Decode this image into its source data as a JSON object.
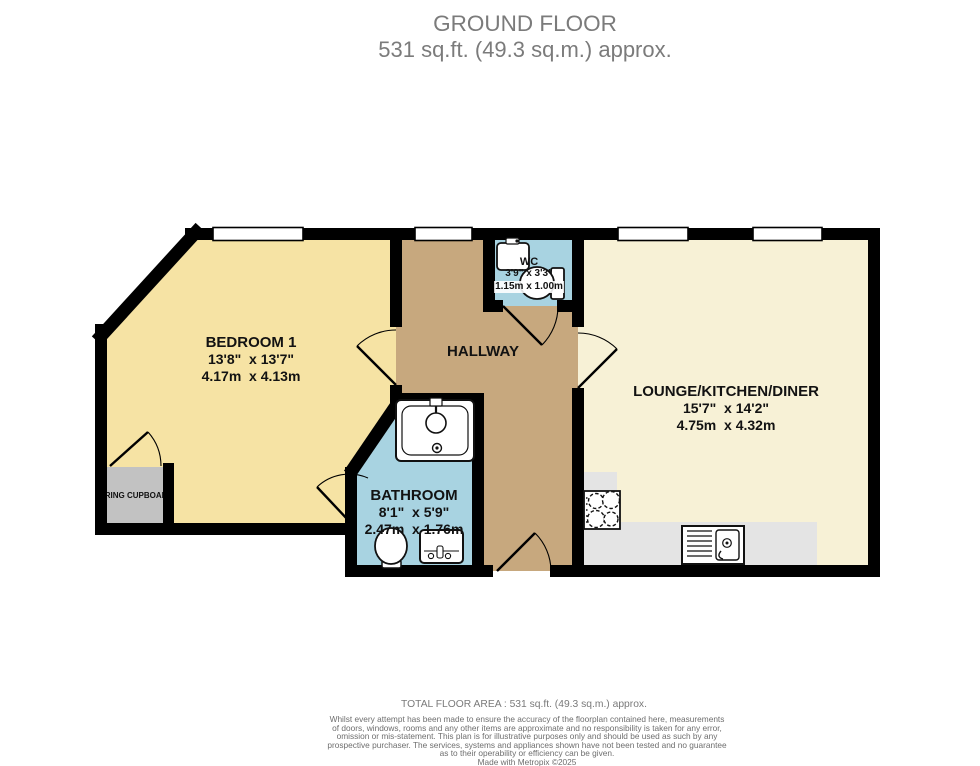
{
  "title": {
    "line1": "GROUND FLOOR",
    "line2": "531 sq.ft. (49.3 sq.m.) approx."
  },
  "rooms": {
    "bedroom": {
      "name": "BEDROOM 1",
      "imperial": "13'8\"  x 13'7\"",
      "metric": "4.17m  x 4.13m"
    },
    "hallway": {
      "name": "HALLWAY"
    },
    "lounge": {
      "name": "LOUNGE/KITCHEN/DINER",
      "imperial": "15'7\"  x 14'2\"",
      "metric": "4.75m  x 4.32m"
    },
    "bathroom": {
      "name": "BATHROOM",
      "imperial": "8'1\"  x 5'9\"",
      "metric": "2.47m  x 1.76m"
    },
    "wc": {
      "name": "WC",
      "imperial": "3'9\" x 3'3\"",
      "metric": "1.15m x 1.00m"
    },
    "airing_cupboard": {
      "name": "AIRING CUPBOARD"
    }
  },
  "footer": {
    "total_area": "TOTAL FLOOR AREA : 531 sq.ft. (49.3 sq.m.) approx.",
    "disclaimer": "Whilst every attempt has been made to ensure the accuracy of the floorplan contained here, measurements\nof doors, windows, rooms and any other items are approximate and no responsibility is taken for any error,\nomission or mis-statement. This plan is for illustrative purposes only and should be used as such by any\nprospective purchaser. The services, systems and appliances shown have not been tested and no guarantee\nas to their operability or efficiency can be given.",
    "credit": "Made with Metropix ©2025"
  },
  "colors": {
    "wall": "#000000",
    "bedroom": "#f6e3a4",
    "lounge": "#f7f1d6",
    "hallway": "#c7a87e",
    "bathroom": "#a8d3e1",
    "wc": "#a8d3e1",
    "counter": "#e4e4e4",
    "cupboard": "#c2c2c2",
    "window": "#ffffff",
    "title_text": "#7b7b7b",
    "footer_text": "#6e6e6e"
  }
}
